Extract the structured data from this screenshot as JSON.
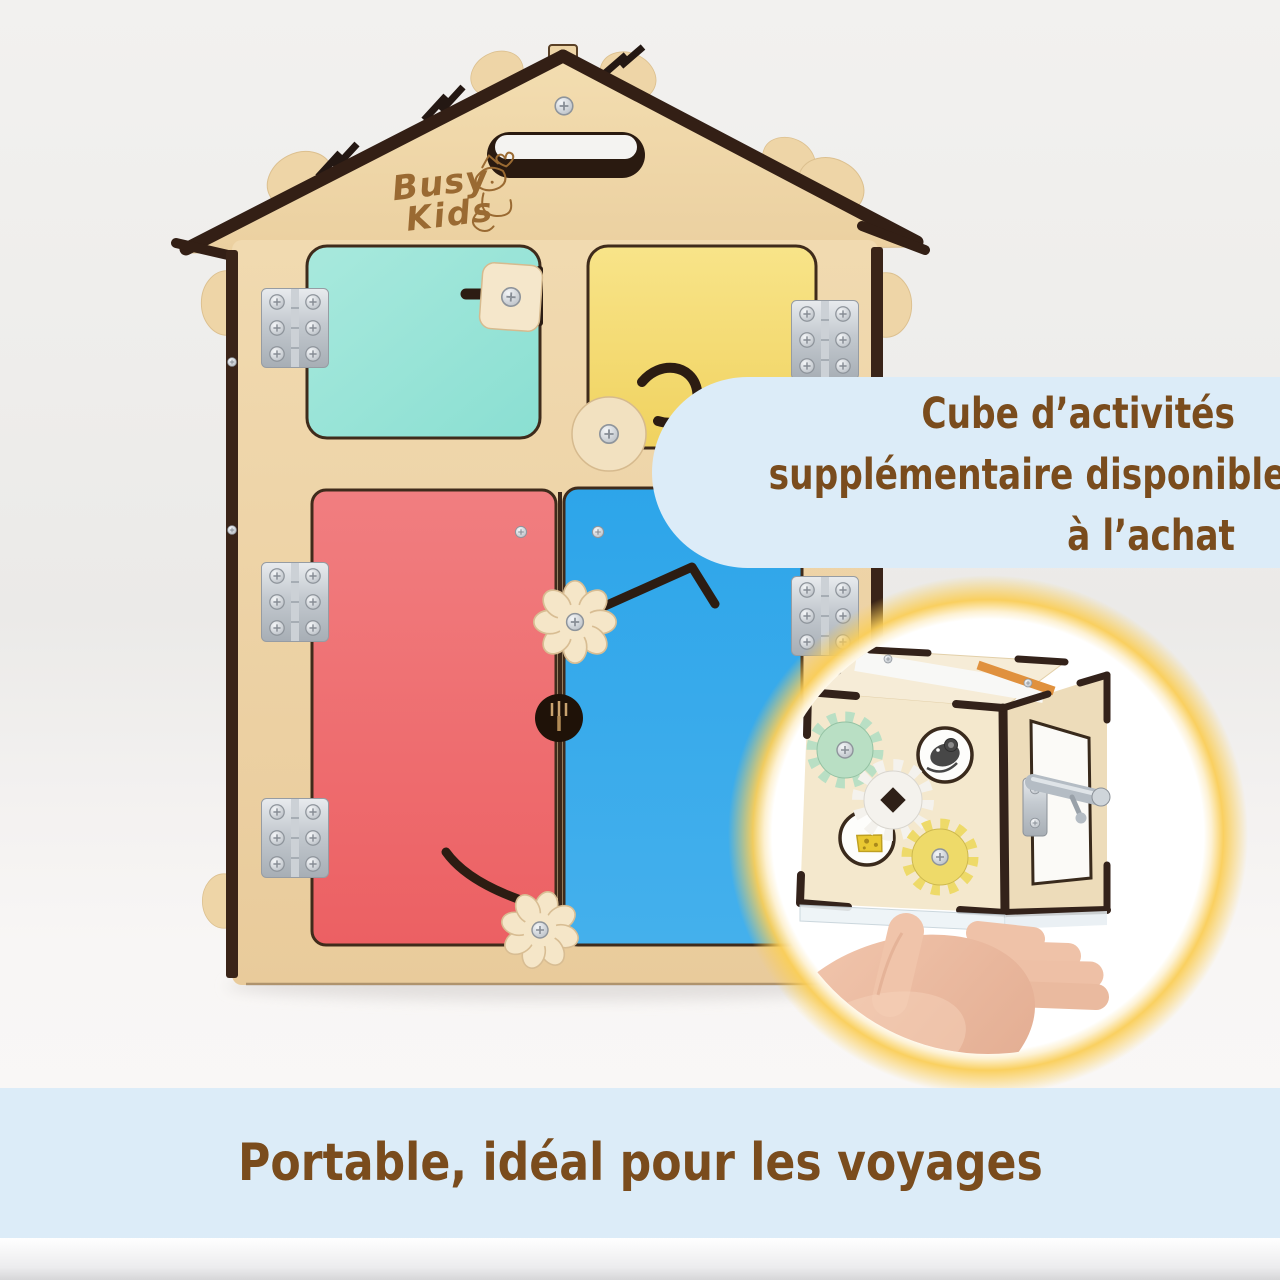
{
  "image_type": "product-marketing-photo",
  "overlay": {
    "bubble": {
      "lines": [
        "Cube d’activités",
        "supplémentaire disponible",
        "à l’achat"
      ]
    },
    "banner": {
      "text": "Portable, idéal pour les voyages"
    }
  },
  "product": {
    "brand_logo": {
      "line1": "Busy",
      "line2": "Kids"
    }
  },
  "colors": {
    "overlay_bg": "#dcecf8",
    "overlay_text": "#7a4c1d",
    "wood": "#eed4a6",
    "wood_trim_dark": "#38241a",
    "door_mint": "#97e2d6",
    "door_yellow": "#f4da6e",
    "door_red": "#ee6b6d",
    "door_blue": "#2fa6ea",
    "glow_yellow": "#f8cd5e",
    "gear_mint": "#b9dfc4",
    "gear_white": "#f4f2ed",
    "gear_yellow": "#eeda69",
    "metal": "#c9ced4",
    "skin": "#eec0a6"
  }
}
